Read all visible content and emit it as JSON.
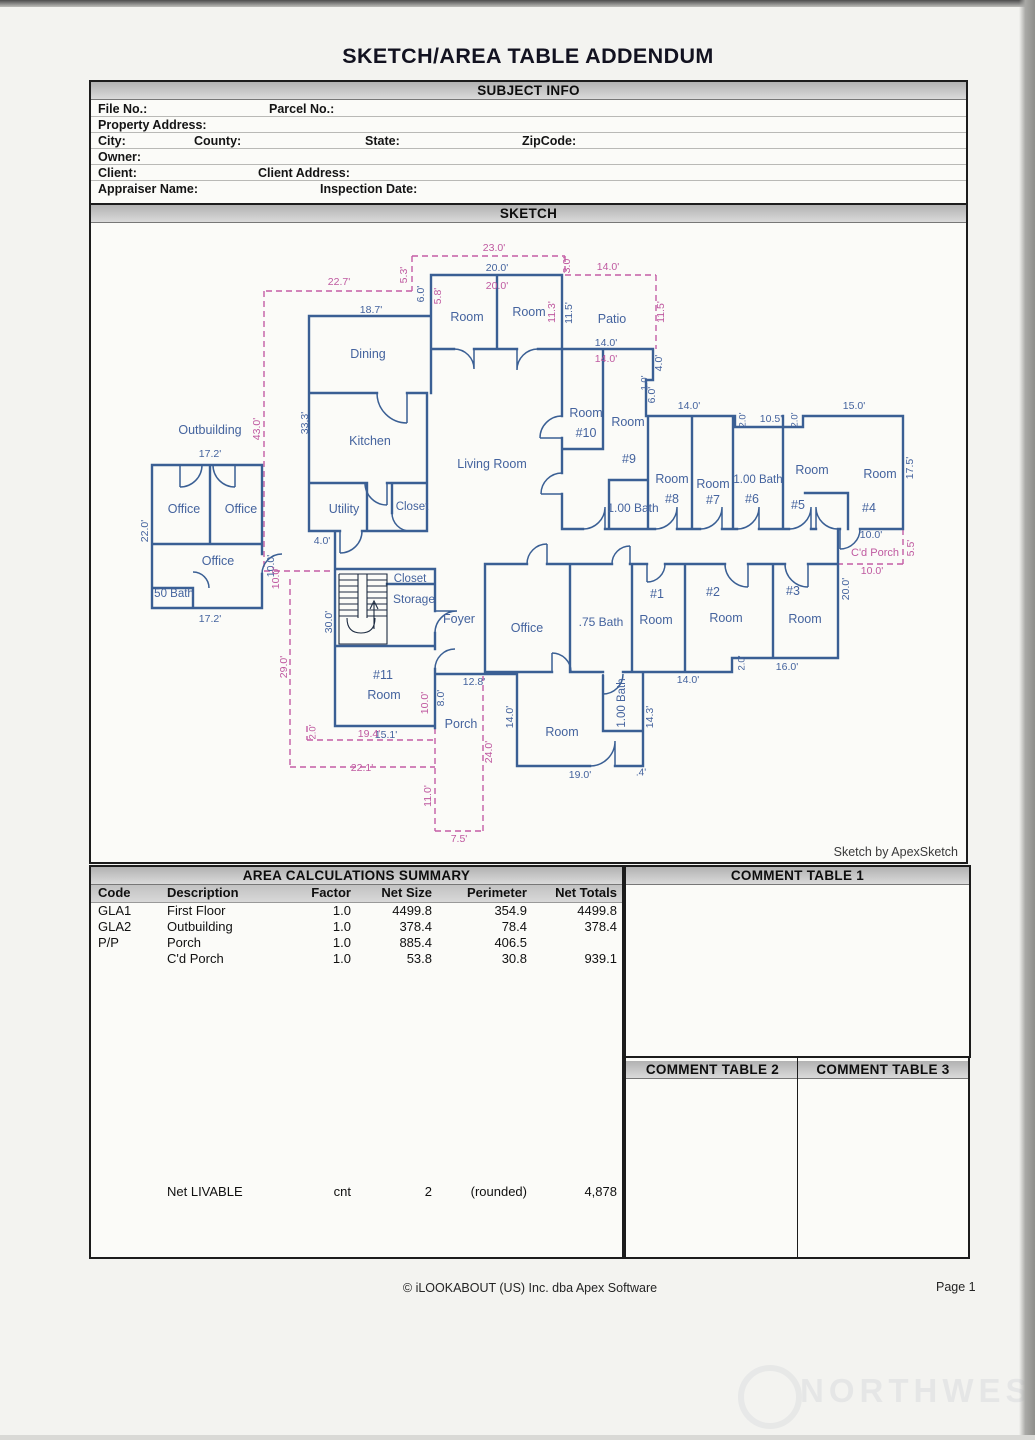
{
  "page": {
    "title": "SKETCH/AREA TABLE ADDENDUM"
  },
  "subject_info": {
    "header": "SUBJECT INFO",
    "labels": {
      "file_no": "File No.:",
      "parcel_no": "Parcel No.:",
      "property_address": "Property Address:",
      "city": "City:",
      "county": "County:",
      "state": "State:",
      "zipcode": "ZipCode:",
      "owner": "Owner:",
      "client": "Client:",
      "client_address": "Client Address:",
      "appraiser_name": "Appraiser Name:",
      "inspection_date": "Inspection Date:"
    }
  },
  "sketch": {
    "header": "SKETCH",
    "credit": "Sketch by ApexSketch",
    "colors": {
      "wall": "#3a5f94",
      "label_blue": "#44639e",
      "label_pink": "#bf59a0"
    },
    "labels": [
      [
        "Outbuilding",
        210,
        429,
        0,
        "b",
        12.5
      ],
      [
        "Office",
        184,
        508,
        0,
        "b",
        12.5
      ],
      [
        "Office",
        241,
        508,
        0,
        "b",
        12.5
      ],
      [
        "Office",
        218,
        560,
        0,
        "b",
        12.5
      ],
      [
        "50 Bath",
        174,
        593,
        0,
        "b",
        11.5
      ],
      [
        "Dining",
        368,
        353,
        0,
        "b",
        12.5
      ],
      [
        "Kitchen",
        370,
        440,
        0,
        "b",
        12.5
      ],
      [
        "Utility",
        344,
        508,
        0,
        "b",
        12.5
      ],
      [
        "Closet",
        412,
        506,
        0,
        "b",
        11.5
      ],
      [
        "Living Room",
        492,
        463,
        0,
        "b",
        12.5
      ],
      [
        "Room",
        467,
        316,
        0,
        "b",
        12.5
      ],
      [
        "Room",
        529,
        311,
        0,
        "b",
        12.5
      ],
      [
        "Patio",
        612,
        318,
        0,
        "b",
        12.5
      ],
      [
        "Room",
        586,
        412,
        0,
        "b",
        12.5
      ],
      [
        "#10",
        586,
        432,
        0,
        "b",
        12.5
      ],
      [
        "Room",
        628,
        421,
        0,
        "b",
        12.5
      ],
      [
        "#9",
        629,
        458,
        0,
        "b",
        12.5
      ],
      [
        "1.00 Bath",
        633,
        507,
        0,
        "b",
        12
      ],
      [
        "Room",
        672,
        478,
        0,
        "b",
        12.5
      ],
      [
        "#8",
        672,
        498,
        0,
        "b",
        12.5
      ],
      [
        "Room",
        713,
        483,
        0,
        "b",
        12.5
      ],
      [
        "#7",
        713,
        499,
        0,
        "b",
        12.5
      ],
      [
        "1.00 Bath",
        758,
        479,
        0,
        "b",
        11.5
      ],
      [
        "#6",
        752,
        498,
        0,
        "b",
        12.5
      ],
      [
        "Room",
        812,
        469,
        0,
        "b",
        12.5
      ],
      [
        "#5",
        798,
        504,
        0,
        "b",
        12.5
      ],
      [
        "Room",
        880,
        473,
        0,
        "b",
        12.5
      ],
      [
        "#4",
        869,
        507,
        0,
        "b",
        12.5
      ],
      [
        "Closet",
        410,
        578,
        0,
        "b",
        11.5
      ],
      [
        "Storage",
        414,
        598,
        0,
        "b",
        12
      ],
      [
        "Foyer",
        459,
        618,
        0,
        "b",
        12.5
      ],
      [
        "Office",
        527,
        627,
        0,
        "b",
        12.5
      ],
      [
        ".75 Bath",
        601,
        621,
        0,
        "b",
        12
      ],
      [
        "#1",
        657,
        593,
        0,
        "b",
        12.5
      ],
      [
        "Room",
        656,
        619,
        0,
        "b",
        12.5
      ],
      [
        "#2",
        713,
        591,
        0,
        "b",
        12.5
      ],
      [
        "Room",
        726,
        617,
        0,
        "b",
        12.5
      ],
      [
        "#3",
        793,
        590,
        0,
        "b",
        12.5
      ],
      [
        "Room",
        805,
        618,
        0,
        "b",
        12.5
      ],
      [
        "#11",
        383,
        674,
        0,
        "b",
        12.5
      ],
      [
        "Room",
        384,
        694,
        0,
        "b",
        12.5
      ],
      [
        "Porch",
        461,
        723,
        0,
        "b",
        12.5
      ],
      [
        "Room",
        562,
        731,
        0,
        "b",
        12.5
      ],
      [
        "20.0'",
        497,
        267,
        0,
        "b",
        10.5
      ],
      [
        "18.7'",
        371,
        309,
        0,
        "b",
        10.5
      ],
      [
        "6.0'",
        421,
        293,
        -90,
        "b",
        10.5
      ],
      [
        "11.5'",
        569,
        312,
        -90,
        "b",
        10.5
      ],
      [
        "14.0'",
        606,
        342,
        0,
        "b",
        10.5
      ],
      [
        "4.0'",
        659,
        362,
        -90,
        "b",
        10.5
      ],
      [
        "1.0'",
        645,
        382,
        -90,
        "b",
        9.5
      ],
      [
        "6.0'",
        652,
        394,
        -90,
        "b",
        10.5
      ],
      [
        "14.0'",
        689,
        405,
        0,
        "b",
        10.5
      ],
      [
        "2.0'",
        743,
        419,
        -90,
        "b",
        9.5
      ],
      [
        "10.5'",
        771,
        418,
        0,
        "b",
        10.5
      ],
      [
        "2.0'",
        795,
        419,
        -90,
        "b",
        9.5
      ],
      [
        "15.0'",
        854,
        405,
        0,
        "b",
        10.5
      ],
      [
        "17.5'",
        910,
        467,
        -90,
        "b",
        10.5
      ],
      [
        "33.3'",
        305,
        422,
        -90,
        "b",
        10.5
      ],
      [
        "17.2'",
        210,
        453,
        0,
        "b",
        10.5
      ],
      [
        "22.0'",
        145,
        530,
        -90,
        "b",
        10.5
      ],
      [
        "17.2'",
        210,
        618,
        0,
        "b",
        10.5
      ],
      [
        "10.0'",
        271,
        565,
        -90,
        "b",
        10.5
      ],
      [
        "4.0'",
        322,
        540,
        0,
        "b",
        10.5
      ],
      [
        "10.0'",
        871,
        534,
        0,
        "b",
        10.5
      ],
      [
        "20.0'",
        846,
        588,
        -90,
        "b",
        10.5
      ],
      [
        "16.0'",
        787,
        666,
        0,
        "b",
        10.5
      ],
      [
        "2.0'",
        742,
        662,
        -90,
        "b",
        9.5
      ],
      [
        "14.0'",
        688,
        679,
        0,
        "b",
        10.5
      ],
      [
        "14.3'",
        650,
        716,
        -90,
        "b",
        10.5
      ],
      [
        ".4'",
        641,
        772,
        0,
        "b",
        10
      ],
      [
        "19.0'",
        580,
        774,
        0,
        "b",
        10.5
      ],
      [
        "14.0'",
        510,
        716,
        -90,
        "b",
        10.5
      ],
      [
        "12.8'",
        474,
        681,
        0,
        "b",
        10.5
      ],
      [
        "8.0'",
        441,
        697,
        -90,
        "b",
        10.5
      ],
      [
        "30.0'",
        329,
        621,
        -90,
        "b",
        10.5
      ],
      [
        "15.1'",
        386,
        734,
        0,
        "b",
        10.5
      ],
      [
        "1.00 Bath",
        622,
        702,
        -90,
        "b",
        11.5
      ],
      [
        "23.0'",
        494,
        247,
        0,
        "p",
        10.5
      ],
      [
        "20.0'",
        497,
        285,
        0,
        "p",
        10.5
      ],
      [
        "3.0'",
        567,
        264,
        -90,
        "p",
        10.5
      ],
      [
        "14.0'",
        608,
        266,
        0,
        "p",
        10.5
      ],
      [
        "5.3'",
        404,
        274,
        -90,
        "p",
        10.5
      ],
      [
        "22.7'",
        339,
        281,
        0,
        "p",
        10.5
      ],
      [
        "5.8'",
        438,
        295,
        -90,
        "p",
        10.5
      ],
      [
        "11.3'",
        552,
        311,
        -90,
        "p",
        10.5
      ],
      [
        "11.5'",
        661,
        311,
        -90,
        "p",
        10.5
      ],
      [
        "14.0'",
        606,
        358,
        0,
        "p",
        10.5
      ],
      [
        "43.0'",
        257,
        428,
        -90,
        "p",
        10.5
      ],
      [
        "10.0'",
        276,
        577,
        -90,
        "p",
        10.5
      ],
      [
        "C'd Porch",
        875,
        552,
        0,
        "p",
        11
      ],
      [
        "5.5'",
        911,
        547,
        -90,
        "p",
        10.5
      ],
      [
        "10.0'",
        872,
        570,
        0,
        "p",
        10.5
      ],
      [
        "29.0'",
        284,
        666,
        -90,
        "p",
        10.5
      ],
      [
        "2.0'",
        313,
        731,
        -90,
        "p",
        9.5
      ],
      [
        "19.4'",
        369,
        733,
        0,
        "p",
        10.5
      ],
      [
        "22.1'",
        362,
        767,
        0,
        "p",
        10.5
      ],
      [
        "10.0'",
        425,
        702,
        -90,
        "p",
        10.5
      ],
      [
        "24.0'",
        489,
        751,
        -90,
        "p",
        10.5
      ],
      [
        "11.0'",
        428,
        795,
        -90,
        "p",
        10.5
      ],
      [
        "7.5'",
        459,
        838,
        0,
        "p",
        10.5
      ]
    ]
  },
  "area_summary": {
    "header": "AREA CALCULATIONS SUMMARY",
    "columns": [
      "Code",
      "Description",
      "Factor",
      "Net Size",
      "Perimeter",
      "Net Totals"
    ],
    "rows": [
      [
        "GLA1",
        "First Floor",
        "1.0",
        "4499.8",
        "354.9",
        "4499.8"
      ],
      [
        "GLA2",
        "Outbuilding",
        "1.0",
        "378.4",
        "78.4",
        "378.4"
      ],
      [
        "P/P",
        "Porch",
        "1.0",
        "885.4",
        "406.5",
        ""
      ],
      [
        "",
        "C'd Porch",
        "1.0",
        "53.8",
        "30.8",
        "939.1"
      ]
    ],
    "net_row": {
      "label": "Net LIVABLE",
      "cnt": "cnt",
      "count": "2",
      "rounded": "(rounded)",
      "total": "4,878"
    }
  },
  "comment_tables": {
    "table1": "COMMENT TABLE 1",
    "table2": "COMMENT TABLE 2",
    "table3": "COMMENT TABLE 3"
  },
  "footer": {
    "copyright": "© iLOOKABOUT (US) Inc. dba Apex Software",
    "page": "Page 1"
  },
  "watermark": {
    "text": "NORTHWEST"
  }
}
